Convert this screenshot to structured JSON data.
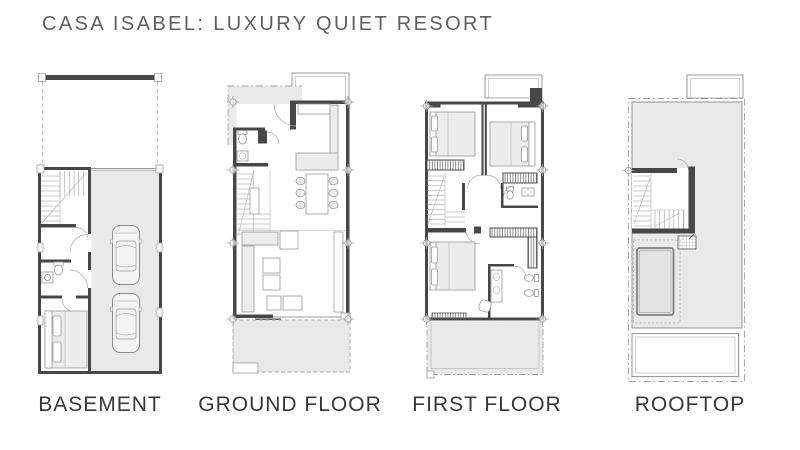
{
  "page": {
    "title": "CASA ISABEL: LUXURY QUIET RESORT",
    "background_color": "#ffffff"
  },
  "plans": [
    {
      "id": "basement",
      "label": "BASEMENT",
      "features": [
        "staircase",
        "hallway",
        "bathroom",
        "storage-room-bed",
        "two-car-garage",
        "driveway"
      ]
    },
    {
      "id": "ground-floor",
      "label": "GROUND FLOOR",
      "features": [
        "entry-porch",
        "guest-wc",
        "kitchen",
        "dining-table-six-chairs",
        "staircase",
        "living-room",
        "rear-terrace"
      ]
    },
    {
      "id": "first-floor",
      "label": "FIRST FLOOR",
      "features": [
        "bedroom",
        "bedroom",
        "bathroom",
        "staircase",
        "wardrobes",
        "master-bedroom",
        "ensuite-bathroom",
        "rear-terrace"
      ]
    },
    {
      "id": "rooftop",
      "label": "ROOFTOP",
      "features": [
        "roof-terrace",
        "stair-enclosure",
        "plunge-pool",
        "lower-roof-deck"
      ]
    }
  ],
  "colors": {
    "wall": "#474747",
    "floor_fill": "#e9e9e9",
    "drawing_line": "#9a9a9a",
    "title_text": "#5f5f5f",
    "label_text": "#383838"
  }
}
